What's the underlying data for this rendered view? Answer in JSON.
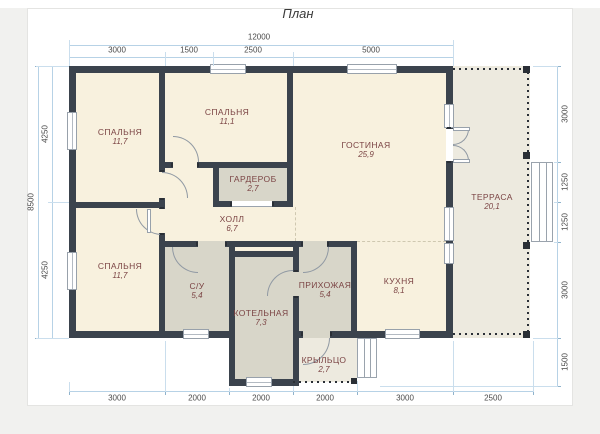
{
  "title": "План",
  "rooms": [
    {
      "id": "bedroom-top-left",
      "name": "СПАЛЬНЯ",
      "area": "11,7"
    },
    {
      "id": "bedroom-top-middle",
      "name": "СПАЛЬНЯ",
      "area": "11,1"
    },
    {
      "id": "living-room",
      "name": "ГОСТИНАЯ",
      "area": "25,9"
    },
    {
      "id": "wardrobe",
      "name": "ГАРДЕРОБ",
      "area": "2,7"
    },
    {
      "id": "hall",
      "name": "ХОЛЛ",
      "area": "6,7"
    },
    {
      "id": "bedroom-bottom-left",
      "name": "СПАЛЬНЯ",
      "area": "11,7"
    },
    {
      "id": "bathroom",
      "name": "С/У",
      "area": "5,4"
    },
    {
      "id": "boiler-room",
      "name": "КОТЕЛЬНАЯ",
      "area": "7,3"
    },
    {
      "id": "entrance-hall",
      "name": "ПРИХОЖАЯ",
      "area": "5,4"
    },
    {
      "id": "kitchen",
      "name": "КУХНЯ",
      "area": "8,1"
    },
    {
      "id": "terrace",
      "name": "ТЕРРАСА",
      "area": "20,1"
    },
    {
      "id": "porch",
      "name": "КРЫЛЬЦО",
      "area": "2,7"
    }
  ],
  "dims": {
    "top": {
      "total": "12000",
      "segments": [
        "3000",
        "1500",
        "2500",
        "5000"
      ]
    },
    "left": {
      "total": "8500",
      "segments": [
        "4250",
        "4250"
      ]
    },
    "right": {
      "segments": [
        "3000",
        "1250",
        "1250",
        "3000",
        "1500"
      ]
    },
    "bottom": {
      "segments": [
        "3000",
        "2000",
        "2000",
        "2000",
        "3000",
        "2500"
      ]
    }
  },
  "colors": {
    "wall": "#3b434d",
    "room_cream": "#f8f1de",
    "room_gray": "#d8d6c9",
    "outdoor": "#edeadf",
    "dimension_line": "#b7d2e6",
    "room_label": "#7b4444"
  }
}
